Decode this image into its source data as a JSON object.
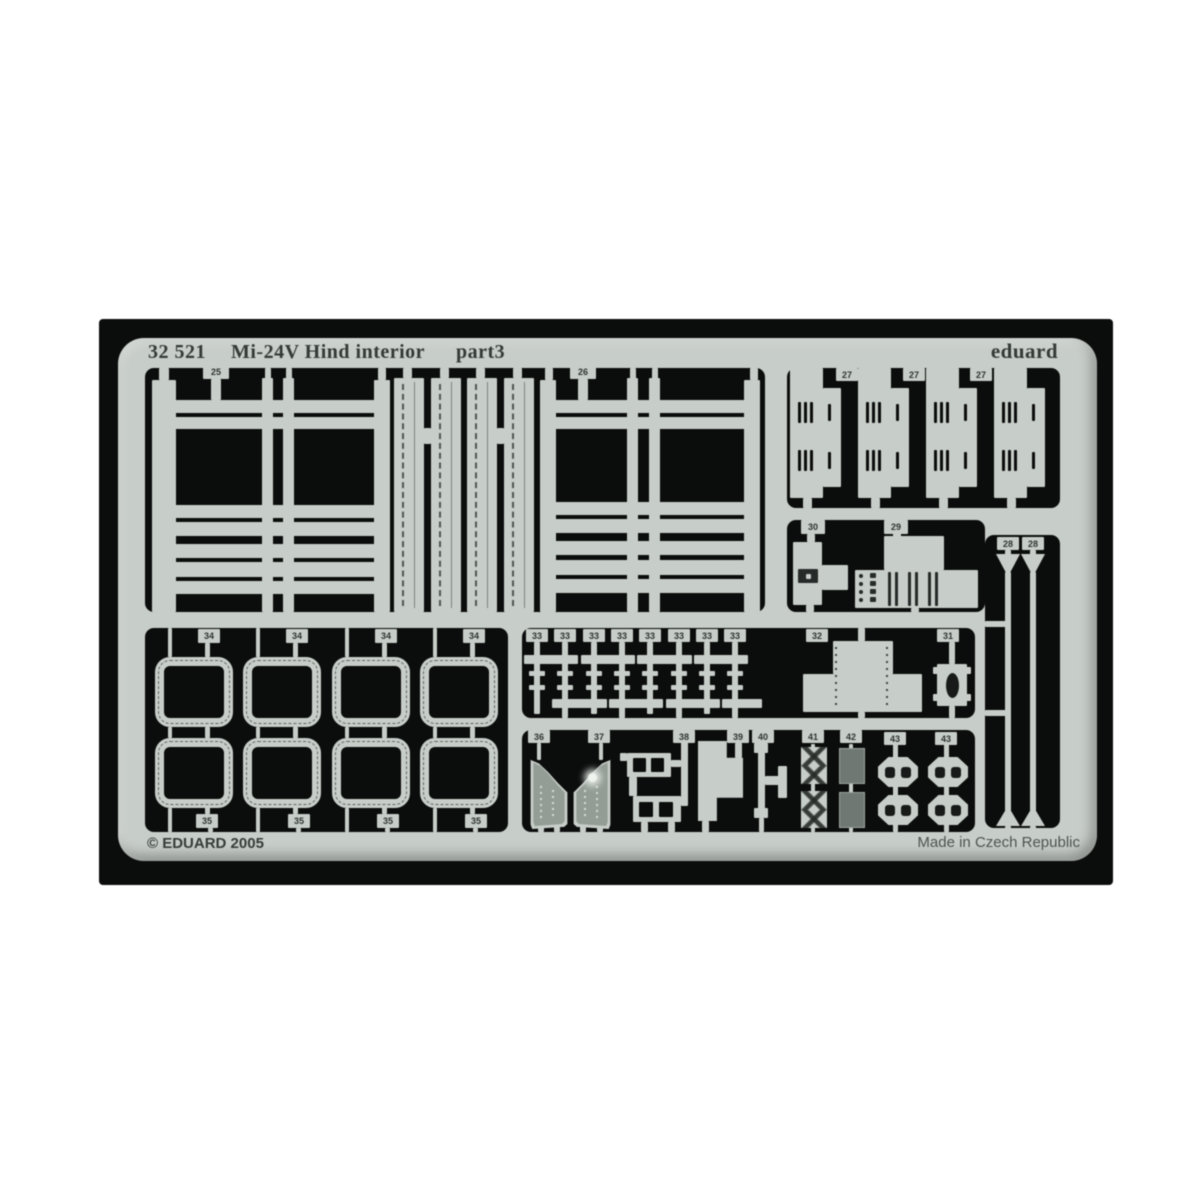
{
  "header": {
    "code": "32 521",
    "title": "Mi-24V Hind interior",
    "part": "part3",
    "brand": "eduard"
  },
  "footer": {
    "copyright": "© EDUARD 2005",
    "made_in": "Made in Czech Republic"
  },
  "tags": {
    "25": "25",
    "26": "26",
    "27": "27",
    "28": "28",
    "29": "29",
    "30": "30",
    "31": "31",
    "32": "32",
    "33": "33",
    "34": "34",
    "35": "35",
    "36": "36",
    "37": "37",
    "38": "38",
    "39": "39",
    "40": "40",
    "41": "41",
    "42": "42",
    "43": "43"
  },
  "colors": {
    "metal": "#c7cdc8",
    "backdrop": "#0b0d0c",
    "etched_dark": "#262b29",
    "recessed_gray": "#6f7872",
    "panel_gray": "#939c95",
    "text_dark": "#343a37",
    "made_in_text": "#4d544f"
  }
}
